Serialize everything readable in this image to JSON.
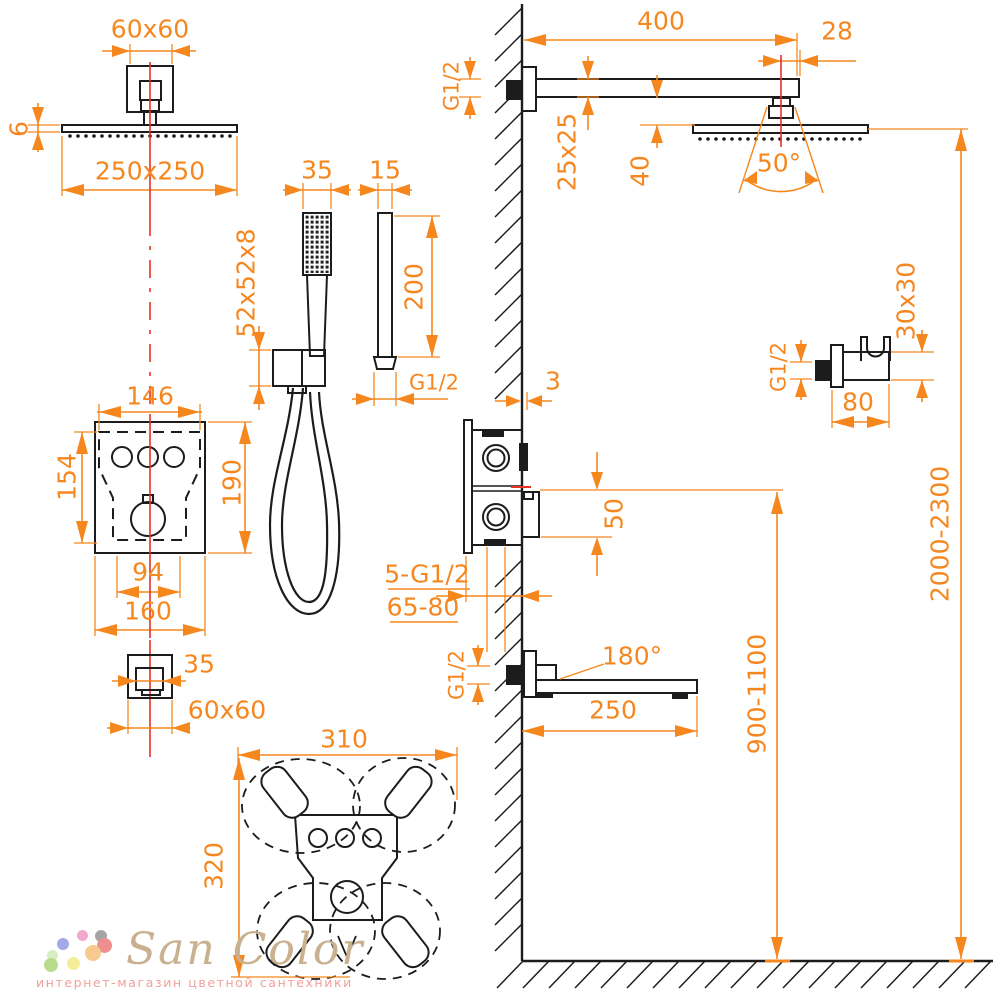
{
  "drawing": {
    "dimension_color": "#f6871f",
    "line_color": "#1c1c1c",
    "centerline_color": "#e53126"
  },
  "labels": {
    "head_mount_size": "60x60",
    "head_thickness": "6",
    "head_size": "250x250",
    "handshower_width": "35",
    "wand_width": "15",
    "holder_size": "52x52x8",
    "wand_length": "200",
    "handshower_thread": "G1/2",
    "panel_width_inner": "146",
    "panel_height_inner": "154",
    "panel_height": "190",
    "panel_feet_span": "94",
    "panel_width": "160",
    "ceiling_escutcheon_inner": "35",
    "ceiling_escutcheon_size": "60x60",
    "clearance_width": "310",
    "clearance_height": "320",
    "arm_length": "400",
    "arm_head_offset": "28",
    "arm_thread": "G1/2",
    "arm_section": "25x25",
    "arm_head_gap": "40",
    "spray_angle": "50°",
    "holder_thread": "G1/2",
    "holder_section": "30x30",
    "holder_depth": "80",
    "valve_plate_offset": "3",
    "valve_trim_height": "50",
    "valve_connections": "5-G1/2",
    "valve_depth_range": "65-80",
    "spout_thread": "G1/2",
    "spout_swivel": "180°",
    "spout_length": "250",
    "spout_height_range": "900-1100",
    "head_height_range": "2000-2300"
  },
  "logo": {
    "brand": "San Color",
    "tagline": "интернет-магазин цветной сантехники",
    "dot_colors": [
      "#a3a8e6",
      "#f2a7cc",
      "#a5a5a5",
      "#ef8e8e",
      "#f6c98e",
      "#d8edc0",
      "#b9dc8a",
      "#f4ee9b"
    ]
  }
}
